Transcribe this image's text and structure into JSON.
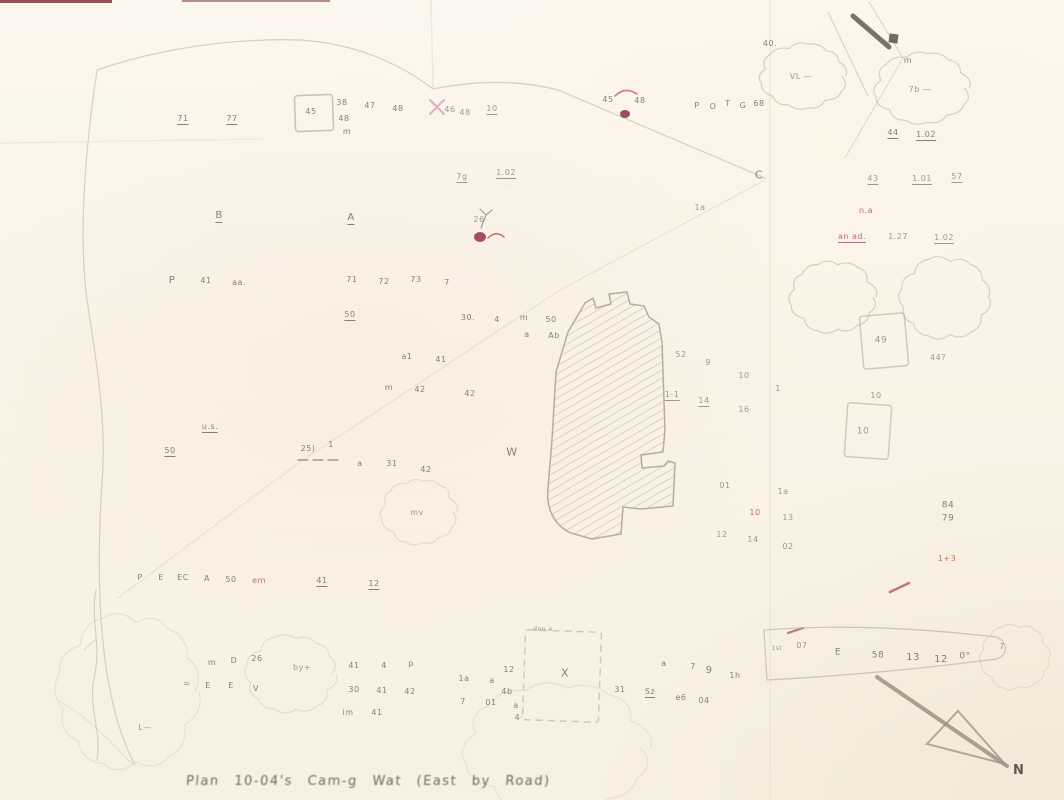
{
  "map": {
    "caption": "Plan  10-04's  Cam-g  Wat  (East by Road)",
    "north_label": "N",
    "palette": {
      "g": "#8f887c",
      "d": "#756b5e",
      "r": "#b25560",
      "m": "#93325a",
      "b": "#a9654f"
    },
    "marks": [
      [
        183,
        120,
        "71",
        "d",
        1
      ],
      [
        232,
        120,
        "77",
        "d",
        1
      ],
      [
        311,
        112,
        "45",
        "d",
        0
      ],
      [
        342,
        103,
        "38",
        "d",
        0
      ],
      [
        344,
        119,
        "48",
        "d",
        0
      ],
      [
        347,
        132,
        "m",
        "d",
        0
      ],
      [
        370,
        106,
        "47",
        "d",
        0
      ],
      [
        398,
        109,
        "48",
        "d",
        0
      ],
      [
        450,
        110,
        "46",
        "g",
        0
      ],
      [
        465,
        113,
        "48",
        "g",
        0
      ],
      [
        492,
        110,
        "10",
        "g",
        1
      ],
      [
        608,
        100,
        "45",
        "d",
        0
      ],
      [
        640,
        101,
        "48",
        "d",
        0
      ],
      [
        697,
        106,
        "P",
        "d",
        0
      ],
      [
        713,
        107,
        "O",
        "d",
        0
      ],
      [
        728,
        104,
        "T",
        "d",
        0
      ],
      [
        743,
        106,
        "G",
        "d",
        0
      ],
      [
        759,
        104,
        "68",
        "d",
        0
      ],
      [
        770,
        44,
        "40.",
        "d",
        0
      ],
      [
        801,
        77,
        "VL —",
        "g",
        0
      ],
      [
        908,
        61,
        "m",
        "d",
        0
      ],
      [
        920,
        90,
        "7b —",
        "g",
        0
      ],
      [
        893,
        134,
        "44",
        "d",
        1
      ],
      [
        926,
        136,
        "1.02",
        "d",
        1
      ],
      [
        873,
        180,
        "43",
        "g",
        1
      ],
      [
        922,
        180,
        "1.01",
        "g",
        1
      ],
      [
        957,
        178,
        "57",
        "g",
        1
      ],
      [
        759,
        175,
        "C",
        "d",
        0,
        11
      ],
      [
        700,
        208,
        "1a",
        "g",
        0
      ],
      [
        462,
        178,
        "7g",
        "g",
        1
      ],
      [
        506,
        174,
        "1.02",
        "g",
        1
      ],
      [
        506,
        187,
        "· · ·",
        "g",
        0,
        5
      ],
      [
        479,
        220,
        "26",
        "g",
        0
      ],
      [
        219,
        217,
        "B",
        "d",
        1,
        10
      ],
      [
        351,
        219,
        "A",
        "d",
        1,
        10
      ],
      [
        172,
        281,
        "P",
        "d",
        0,
        10
      ],
      [
        206,
        281,
        "41",
        "d",
        0
      ],
      [
        239,
        283,
        "aa.",
        "d",
        0
      ],
      [
        352,
        280,
        "71",
        "d",
        0
      ],
      [
        384,
        282,
        "72",
        "d",
        0
      ],
      [
        416,
        280,
        "73",
        "d",
        0
      ],
      [
        447,
        283,
        "7",
        "d",
        0
      ],
      [
        350,
        316,
        "50",
        "d",
        1
      ],
      [
        468,
        318,
        "30.",
        "d",
        0
      ],
      [
        497,
        320,
        "4",
        "d",
        0
      ],
      [
        524,
        318,
        "m",
        "d",
        0
      ],
      [
        551,
        320,
        "50",
        "d",
        0
      ],
      [
        527,
        335,
        "a",
        "d",
        0
      ],
      [
        554,
        336,
        "Ab",
        "d",
        0
      ],
      [
        407,
        357,
        "a1",
        "d",
        0
      ],
      [
        441,
        360,
        "41",
        "d",
        0
      ],
      [
        389,
        388,
        "m",
        "d",
        0
      ],
      [
        420,
        390,
        "42",
        "d",
        0
      ],
      [
        470,
        394,
        "42",
        "d",
        0
      ],
      [
        210,
        428,
        "u.s.",
        "d",
        1
      ],
      [
        170,
        452,
        "50",
        "d",
        1
      ],
      [
        308,
        449,
        "25)",
        "d",
        0
      ],
      [
        331,
        445,
        "1",
        "d",
        0
      ],
      [
        360,
        464,
        "a",
        "d",
        0
      ],
      [
        392,
        464,
        "31",
        "d",
        0
      ],
      [
        426,
        470,
        "42",
        "d",
        0
      ],
      [
        512,
        452,
        "W",
        "d",
        0,
        11
      ],
      [
        417,
        513,
        "mv",
        "g",
        0
      ],
      [
        681,
        355,
        "52",
        "g",
        0
      ],
      [
        708,
        363,
        "9",
        "g",
        0
      ],
      [
        744,
        376,
        "10",
        "g",
        0
      ],
      [
        778,
        389,
        "1",
        "g",
        0
      ],
      [
        672,
        396,
        "1-1",
        "g",
        1
      ],
      [
        704,
        402,
        "14",
        "g",
        1
      ],
      [
        744,
        410,
        "16",
        "g",
        0
      ],
      [
        725,
        486,
        "01",
        "g",
        0
      ],
      [
        783,
        492,
        "1a",
        "g",
        0
      ],
      [
        755,
        513,
        "10",
        "b",
        0
      ],
      [
        788,
        518,
        "13",
        "g",
        0
      ],
      [
        722,
        535,
        "12",
        "g",
        0
      ],
      [
        753,
        540,
        "14",
        "g",
        0
      ],
      [
        788,
        547,
        "02",
        "g",
        0
      ],
      [
        881,
        341,
        "49",
        "g",
        0,
        9
      ],
      [
        876,
        396,
        "10",
        "g",
        0
      ],
      [
        863,
        432,
        "10",
        "g",
        0,
        9
      ],
      [
        938,
        358,
        "44?",
        "g",
        0
      ],
      [
        948,
        506,
        "84",
        "d",
        0,
        9
      ],
      [
        948,
        519,
        "79",
        "d",
        0,
        9
      ],
      [
        947,
        559,
        "1+3",
        "b",
        0
      ],
      [
        866,
        211,
        "n.a",
        "r",
        0
      ],
      [
        852,
        238,
        "an ad.",
        "r",
        1
      ],
      [
        898,
        237,
        "1.27",
        "g",
        0
      ],
      [
        944,
        239,
        "1.02",
        "g",
        1
      ],
      [
        140,
        578,
        "P",
        "d",
        0
      ],
      [
        161,
        578,
        "E",
        "d",
        0
      ],
      [
        183,
        578,
        "EC",
        "d",
        0
      ],
      [
        207,
        579,
        "A",
        "d",
        0
      ],
      [
        231,
        580,
        "50",
        "d",
        0
      ],
      [
        259,
        581,
        "em",
        "b",
        0
      ],
      [
        322,
        582,
        "41",
        "d",
        1
      ],
      [
        374,
        585,
        "12",
        "d",
        1
      ],
      [
        212,
        663,
        "m",
        "d",
        0
      ],
      [
        234,
        661,
        "D",
        "d",
        0
      ],
      [
        257,
        659,
        "26",
        "d",
        0
      ],
      [
        302,
        668,
        "by+",
        "g",
        0
      ],
      [
        187,
        684,
        "=",
        "d",
        0
      ],
      [
        208,
        686,
        "E",
        "d",
        0
      ],
      [
        231,
        686,
        "E",
        "d",
        0
      ],
      [
        256,
        689,
        "V",
        "d",
        0
      ],
      [
        145,
        728,
        "L—",
        "g",
        0
      ],
      [
        354,
        666,
        "41",
        "d",
        0
      ],
      [
        384,
        666,
        "4",
        "d",
        0
      ],
      [
        411,
        664,
        "p",
        "d",
        0
      ],
      [
        354,
        690,
        "30",
        "d",
        0
      ],
      [
        382,
        691,
        "41",
        "d",
        0
      ],
      [
        410,
        692,
        "42",
        "d",
        0
      ],
      [
        348,
        713,
        "im",
        "d",
        0
      ],
      [
        377,
        713,
        "41",
        "d",
        0
      ],
      [
        464,
        679,
        "1a",
        "d",
        0
      ],
      [
        492,
        681,
        "a",
        "d",
        0
      ],
      [
        463,
        702,
        "7",
        "d",
        0
      ],
      [
        491,
        703,
        "01",
        "d",
        0
      ],
      [
        516,
        706,
        "a",
        "d",
        0
      ],
      [
        543,
        630,
        "den e",
        "g",
        0,
        6
      ],
      [
        565,
        673,
        "X",
        "d",
        0,
        11
      ],
      [
        509,
        670,
        "12",
        "d",
        0
      ],
      [
        507,
        692,
        "4b",
        "d",
        0
      ],
      [
        519,
        718,
        "4·",
        "d",
        0
      ],
      [
        664,
        664,
        "a",
        "d",
        0
      ],
      [
        693,
        667,
        "7",
        "d",
        0
      ],
      [
        709,
        671,
        "9",
        "d",
        0,
        10
      ],
      [
        735,
        676,
        "1h",
        "d",
        0
      ],
      [
        620,
        690,
        "31",
        "d",
        0
      ],
      [
        650,
        693,
        "Sz",
        "d",
        1
      ],
      [
        681,
        698,
        "e6",
        "d",
        0
      ],
      [
        704,
        701,
        "04",
        "d",
        0
      ],
      [
        777,
        649,
        "1st",
        "g",
        0,
        6
      ],
      [
        802,
        646,
        "07",
        "g",
        0
      ],
      [
        838,
        653,
        "E",
        "d",
        0,
        9
      ],
      [
        878,
        656,
        "58",
        "d",
        0,
        9
      ],
      [
        913,
        658,
        "13",
        "d",
        0,
        10
      ],
      [
        941,
        660,
        "12",
        "d",
        0,
        10
      ],
      [
        965,
        657,
        "0°",
        "d",
        0,
        9
      ],
      [
        1002,
        647,
        "7",
        "g",
        0
      ]
    ],
    "clouds": [
      [
        803,
        76,
        41,
        31,
        0.55
      ],
      [
        922,
        88,
        45,
        34,
        0.5
      ],
      [
        833,
        297,
        41,
        34,
        0.55
      ],
      [
        945,
        298,
        43,
        39,
        0.5
      ],
      [
        419,
        512,
        36,
        31,
        0.32
      ],
      [
        291,
        674,
        43,
        37,
        0.3
      ],
      [
        557,
        748,
        88,
        62,
        0.25
      ],
      [
        1015,
        657,
        33,
        31,
        0.3
      ],
      [
        128,
        692,
        68,
        74,
        0.25
      ]
    ],
    "squares": [
      [
        314,
        113,
        38,
        36,
        -2,
        0.6,
        0
      ],
      [
        884,
        341,
        45,
        53,
        -5,
        0.5,
        0
      ],
      [
        868,
        431,
        44,
        54,
        4,
        0.5,
        0
      ],
      [
        562,
        676,
        76,
        90,
        2,
        0.5,
        1
      ]
    ],
    "building_path": "M585,303 L593,298 L596,308 L611,304 L609,294 L627,292 L630,304 L644,306 L649,317 L659,324 L662,342 L665,430 L663,452 L641,455 L642,468 L664,466 L668,461 L675,463 L673,506 L641,509 L623,507 L621,534 L592,539 L571,533 C553,525 546,507 548,488 L552,440 L556,372 L568,332 Z",
    "lines": [
      [
        "M135,765 C103,705 94,608 102,482 C107,420 96,360 87,300 C80,248 82,170 97,70 C160,48 235,38 300,40 C352,43 398,62 433,89 C478,80 520,80 558,90 L765,178",
        1.2,
        "#cfc5b4",
        0.8,
        ""
      ],
      [
        "M765,180 L560,290 L300,462 L118,598",
        1,
        "#cfc5b4",
        0.45,
        ""
      ],
      [
        "M96,590 C90,618 102,648 94,678 C88,708 102,732 97,760",
        1.2,
        "#c9c0b0",
        0.7,
        ""
      ],
      [
        "M95,640 L84,650",
        1,
        "#c9c0b0",
        0.5,
        ""
      ],
      [
        "M58,700 C85,715 112,742 132,764",
        1,
        "#cfc5b4",
        0.5,
        ""
      ],
      [
        "M770,0 L770,800",
        2,
        "#eee3d3",
        0.6,
        ""
      ],
      [
        "M431,0 L433,88",
        1.5,
        "#eadfcf",
        0.7,
        ""
      ],
      [
        "M0,143 L262,139",
        1.5,
        "#f0e6d6",
        0.8,
        ""
      ],
      [
        "M828,12 L868,96",
        1,
        "#c2b8a8",
        0.6,
        ""
      ],
      [
        "M869,2 L903,58",
        1,
        "#c2b8a8",
        0.6,
        ""
      ],
      [
        "M903,58 L845,158",
        1,
        "#c2b8a8",
        0.5,
        ""
      ],
      [
        "M853,16 L889,47",
        5,
        "#57524c",
        0.8,
        ""
      ],
      [
        "M877,677 L1007,766",
        4,
        "#8d8577",
        0.75,
        ""
      ],
      [
        "M958,711 L1005,764 L927,744 Z",
        2,
        "#9a9284",
        0.75,
        ""
      ],
      [
        "M298,460 h10 m5,0 h10 m5,0 h10",
        1.2,
        "#776f63",
        0.8,
        ""
      ],
      [
        "M615,96 Q625,86 637,94",
        1.5,
        "#c4636f",
        0.85,
        ""
      ],
      [
        "M430,100 L444,114 M444,100 L430,114",
        2,
        "#d394a8",
        0.7,
        ""
      ],
      [
        "M481,228 L486,215 M486,215 L480,209 M486,215 L492,210",
        1.2,
        "#8a9180",
        0.8,
        ""
      ],
      [
        "M488,238 Q496,230 504,237",
        1.5,
        "#b05560",
        0.85,
        ""
      ],
      [
        "M788,633 L803,628",
        2,
        "#b05560",
        0.8,
        ""
      ],
      [
        "M890,592 L909,583",
        2.5,
        "#b0575e",
        0.8,
        ""
      ],
      [
        "M764,630 Q868,622 996,637 M764,630 L767,680 Q880,674 997,659 M996,637 C1008,641 1009,654 997,659",
        1.3,
        "#b6ac9c",
        0.6,
        ""
      ]
    ],
    "ellipses": [
      [
        625,
        114,
        5,
        4,
        "#8d2c4f",
        0.85
      ],
      [
        480,
        237,
        6,
        5,
        "#9c3a5a",
        0.9
      ]
    ],
    "edge_rects": [
      [
        0,
        0,
        112,
        3,
        "#6f1d1d",
        0.75
      ],
      [
        182,
        0,
        148,
        2,
        "#6f1d1d",
        0.5
      ],
      [
        889,
        34,
        9,
        9,
        "#57524c",
        0.85
      ]
    ]
  }
}
